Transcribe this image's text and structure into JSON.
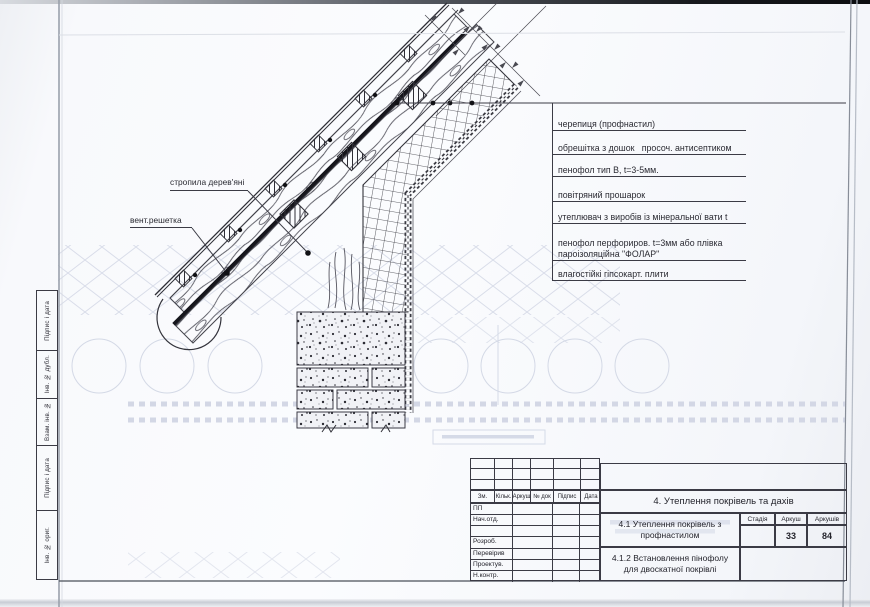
{
  "callouts": {
    "c1": "черепиця (профнастил)",
    "c2": "обрешітка з дошок   просоч. антисептиком",
    "c3": "пенофол тип В, t=3-5мм.",
    "c4": "повітряний прошарок",
    "c5": "утеплювач з виробів із мінеральної вати t",
    "c6a": "пенофол перфориров. t=3мм або плівка",
    "c6b": "пароізоляційна \"ФОЛАР\"",
    "c7": "влагостійкі гіпсокарт. плити"
  },
  "labels": {
    "rafters": "стропила дерев'яні",
    "vent": "вент.решетка"
  },
  "margin_strip": {
    "rows": [
      "Підпис і дата",
      "Інв. № дубл.",
      "Взам. інв. №",
      "Підпис і дата",
      "Інв. № ориг."
    ]
  },
  "title_block": {
    "header_cols": [
      "Зм.",
      "Кільк.",
      "Аркуш",
      "№ док",
      "Підпис",
      "Дата"
    ],
    "left_rows": [
      "ПП",
      "Нач.отд.",
      "",
      "Розроб.",
      "Перевірив",
      "Проектув.",
      "Н.контр."
    ],
    "section_title": "4. Утеплення покрівель та дахів",
    "subtitle1_l1": "4.1 Утеплення покрівель з",
    "subtitle1_l2": "профнастилом",
    "subtitle2_l1": "4.1.2 Встановлення пінофолу",
    "subtitle2_l2": "для двоскатної покрівлі",
    "stage_col": "Стадія",
    "sheet_col": "Аркуш",
    "sheets_col": "Аркушів",
    "stage_val": "",
    "sheet_val": "33",
    "sheets_val": "84"
  },
  "colors": {
    "ink": "#2b2b33",
    "paper": "#f8f9fc",
    "ghost": "#d6dae7"
  }
}
